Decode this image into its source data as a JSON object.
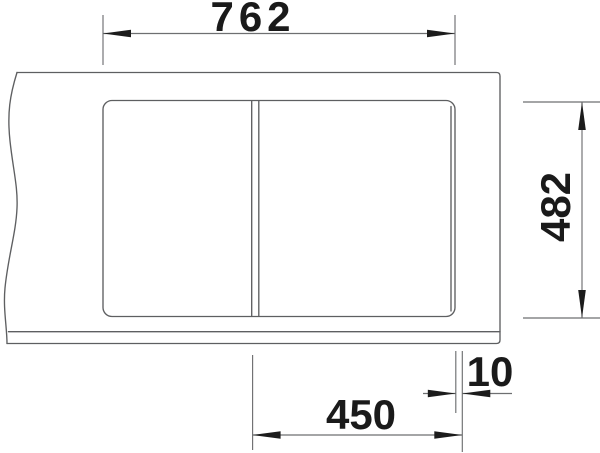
{
  "drawing": {
    "dimensions": {
      "width": "762",
      "depth": "482",
      "bowl_width": "450",
      "edge_offset": "10"
    },
    "colors": {
      "background": "#ffffff",
      "outline": "#5e5f61",
      "dimension_line": "#6e6f71",
      "arrow": "#1c1c1c",
      "label_text": "#1a1a1a"
    }
  }
}
